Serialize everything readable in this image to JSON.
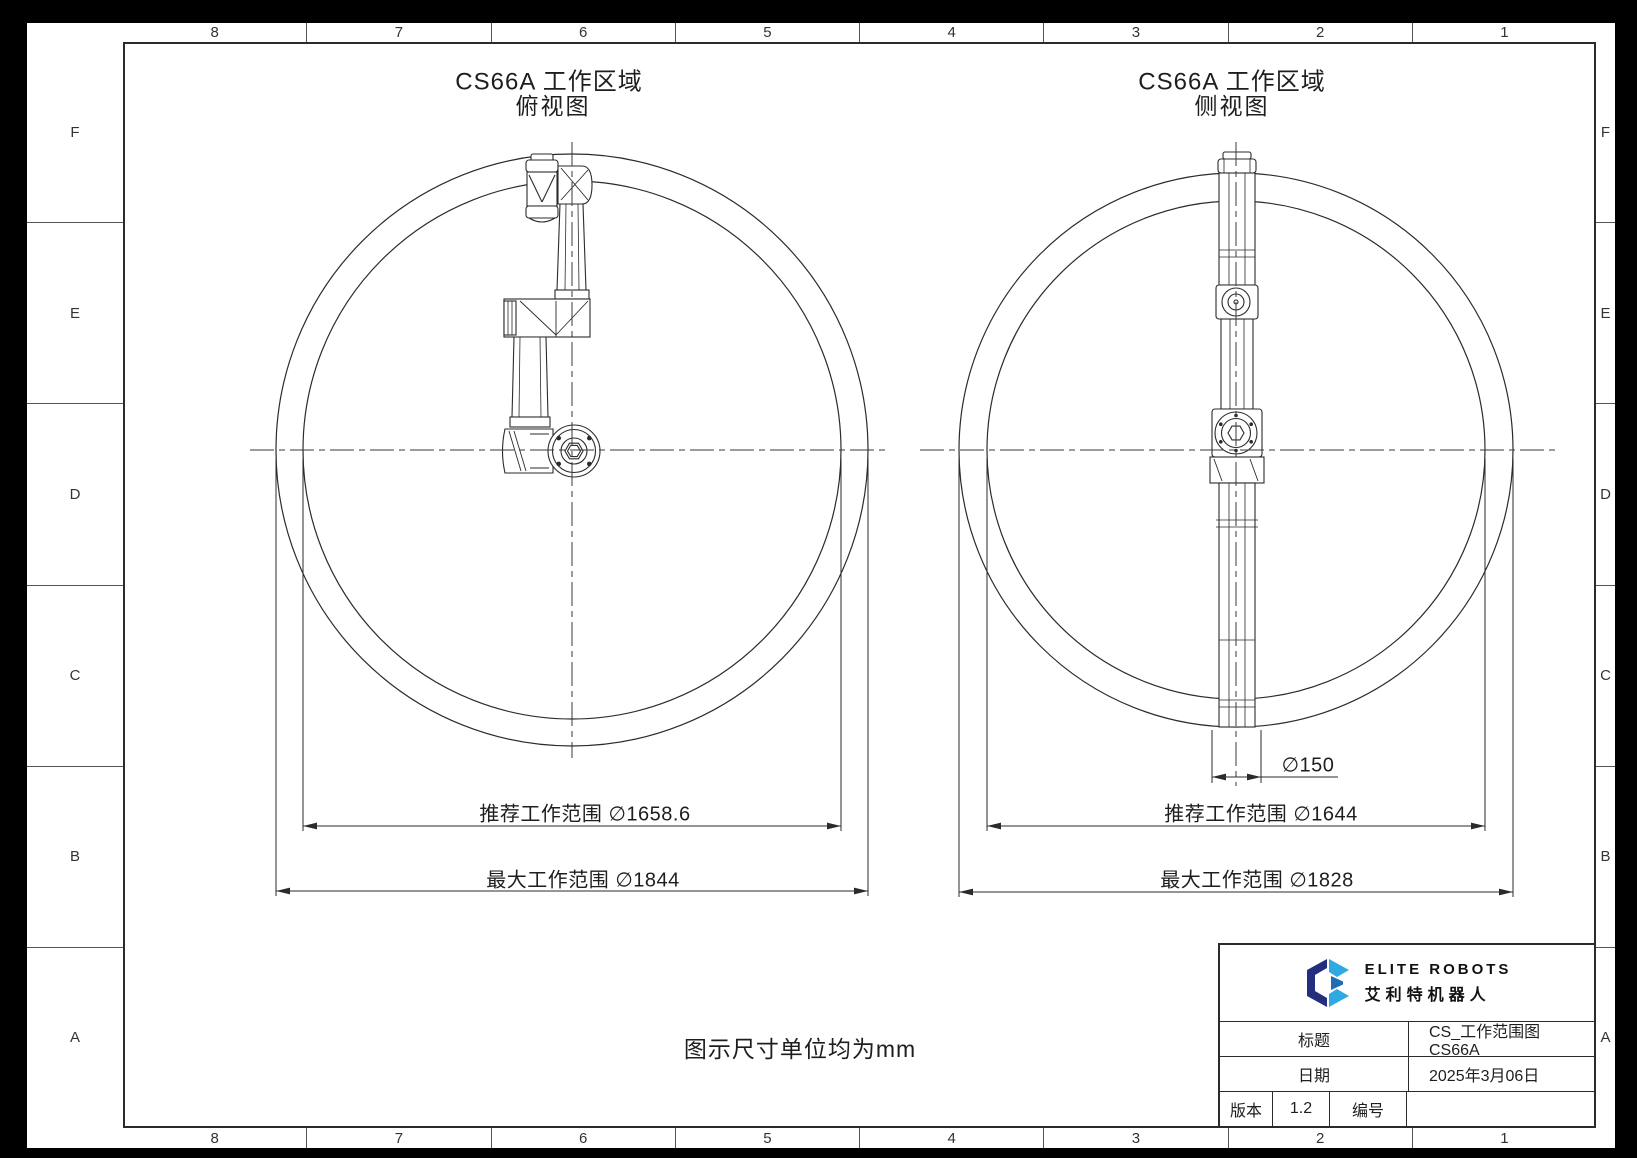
{
  "frame": {
    "columns": [
      "8",
      "7",
      "6",
      "5",
      "4",
      "3",
      "2",
      "1"
    ],
    "rows": [
      "F",
      "E",
      "D",
      "C",
      "B",
      "A"
    ]
  },
  "views": {
    "top_view": {
      "title": "CS66A 工作区域",
      "subtitle": "俯视图",
      "recommended_range_label": "推荐工作范围 ∅1658.6",
      "max_range_label": "最大工作范围 ∅1844"
    },
    "side_view": {
      "title": "CS66A 工作区域",
      "subtitle": "侧视图",
      "tool_diameter_label": "∅150",
      "recommended_range_label": "推荐工作范围 ∅1644",
      "max_range_label": "最大工作范围 ∅1828"
    }
  },
  "note": "图示尺寸单位均为mm",
  "title_block": {
    "logo_text_en": "ELITE ROBOTS",
    "logo_text_cn": "艾利特机器人",
    "title_label": "标题",
    "title_value": "CS_工作范围图 CS66A",
    "date_label": "日期",
    "date_value": "2025年3月06日",
    "version_label": "版本",
    "version_value": "1.2",
    "number_label": "编号",
    "number_value": ""
  },
  "colors": {
    "line": "#2b2b2b",
    "logo_dark": "#232e7d",
    "logo_cyan": "#2ea9e2",
    "logo_mid": "#1f6db5"
  }
}
